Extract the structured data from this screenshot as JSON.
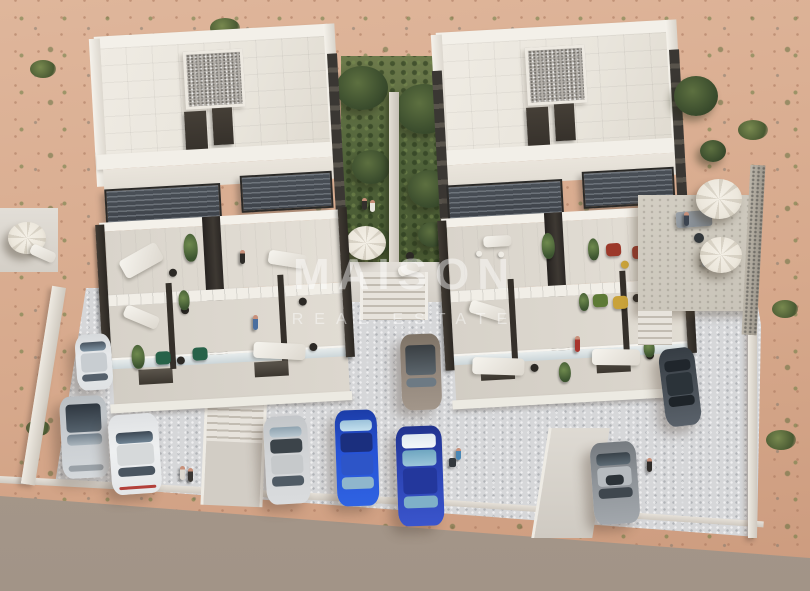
{
  "watermark": {
    "line1": "MAISON",
    "line2": "REAL ESTATE"
  },
  "palette": {
    "sand": "#d7a98c",
    "sand_light": "#dfb69b",
    "road": "#a89a8d",
    "paving": "#d6d7d9",
    "concrete": "#dcd8d0",
    "building": "#f1eee7",
    "roof": "#e9e5dc",
    "gravel": "#b3afa9",
    "pergola": "#3e434a",
    "pillar": "#2c2823",
    "door": "#36312b",
    "garden": "#4f6239",
    "garden_dark": "#3a4c2d",
    "glass": "#c6d1d5",
    "stone": "#c8c3b8",
    "parasol": "#ece7dc",
    "accent_red_chair": "#9c392a",
    "accent_green_chair": "#276249",
    "accent_yellow": "#c9a23a",
    "cars": {
      "white_suv": "#e7e9eb",
      "silver_suv": "#c9cdd1",
      "white_sedan": "#eef0f1",
      "silver_sedan": "#d2d4d6",
      "bronze": "#91857a",
      "blue": "#2753d6",
      "blue_dark": "#2c44b4",
      "charcoal": "#474e55",
      "gray": "#8e9398"
    }
  }
}
